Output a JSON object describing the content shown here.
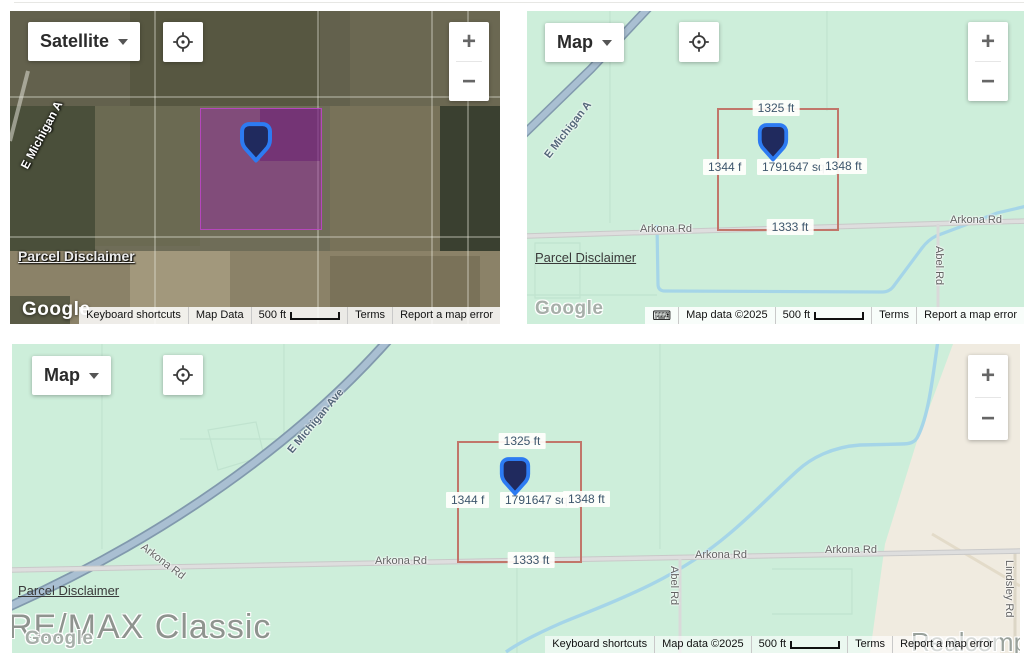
{
  "controls": {
    "satellite_label": "Satellite",
    "map_label": "Map",
    "zoom_in": "+",
    "zoom_out": "−",
    "keyboard_icon": "⌨"
  },
  "parcel": {
    "top": "1325 ft",
    "left": "1344 f",
    "area": "1791647 sqft",
    "right": "1348 ft",
    "bottom": "1333 ft"
  },
  "roads": {
    "e_michigan_abbrev": "E Michigan A",
    "e_michigan": "E Michigan Ave",
    "arkona": "Arkona Rd",
    "abel": "Abel Rd",
    "lindsley": "Lindsley Rd"
  },
  "links": {
    "parcel_disclaimer": "Parcel Disclaimer"
  },
  "google_logo": "Google",
  "footer_satellite": {
    "keyboard_shortcuts": "Keyboard shortcuts",
    "map_data": "Map Data",
    "scale": "500 ft",
    "terms": "Terms",
    "report_error": "Report a map error"
  },
  "footer_map": {
    "keyboard_shortcuts": "Keyboard shortcuts",
    "map_data": "Map data ©2025",
    "scale": "500 ft",
    "terms": "Terms",
    "report_error": "Report a map error"
  },
  "watermarks": {
    "remax": "RE/MAX Classic",
    "realcomp": "Realcomp"
  },
  "colors": {
    "map_green": "#cdeeda",
    "map_beige": "#f0ebe0",
    "water": "#a5d5e8",
    "highway": "#9db4c9",
    "minor_road": "#d9d9d9",
    "parcel_outline": "#c1766a",
    "parcel_fill_satellite": "rgba(148,44,155,0.5)",
    "marker_border": "#2d7bf2",
    "marker_fill": "#202a5e",
    "measure_text": "#3d566c"
  }
}
